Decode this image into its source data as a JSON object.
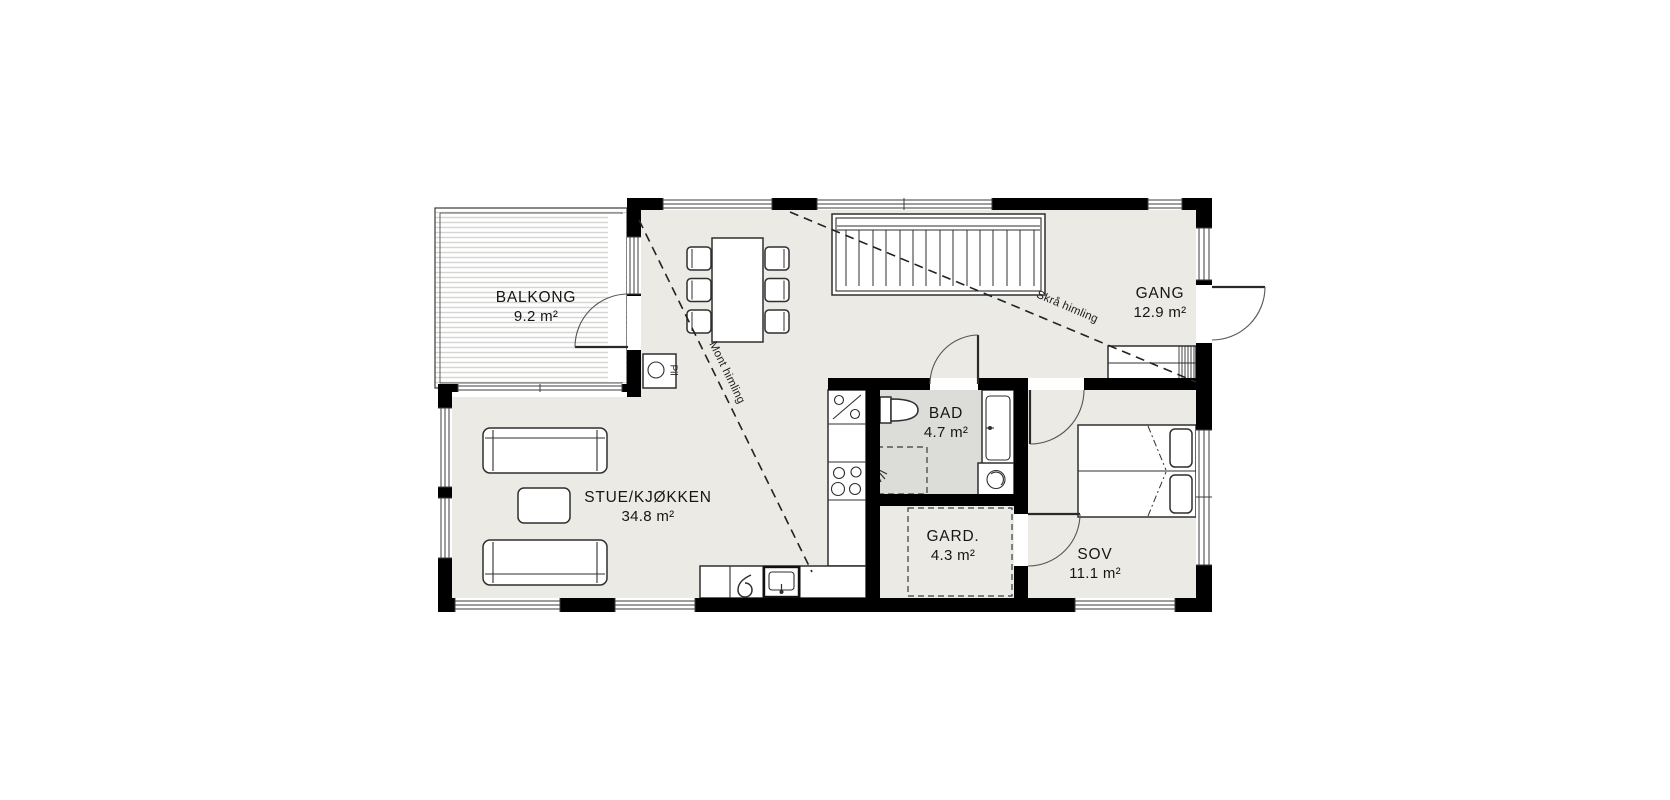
{
  "rooms": {
    "balkong": {
      "name": "BALKONG",
      "area": "9.2 m²"
    },
    "gang": {
      "name": "GANG",
      "area": "12.9 m²"
    },
    "bad": {
      "name": "BAD",
      "area": "4.7 m²"
    },
    "stue_kjokken": {
      "name": "STUE/KJØKKEN",
      "area": "34.8 m²"
    },
    "gard": {
      "name": "GARD.",
      "area": "4.3 m²"
    },
    "sov": {
      "name": "SOV",
      "area": "11.1 m²"
    }
  },
  "annotations": {
    "skra_himling": "Skrå himling",
    "mont_himling": "Mont himling",
    "pillar_label": "Pil"
  },
  "icons": {
    "stairs": "straight-stair-run",
    "dining-table": "table-with-six-chairs",
    "sofa": "three-seat-sofa",
    "coffee-table": "rectangular-table",
    "double-bed": "bed-with-two-pillows",
    "toilet": "wc-tank-and-bowl",
    "bathroom-sink": "vanity-with-faucet",
    "washing-machine": "square-with-drum-circle",
    "shower": "dashed-square-with-spray-head",
    "stove": "cabinet-with-diagonal-and-circles",
    "cooktop": "four-burner-circles",
    "kitchen-sink": "basin-with-faucet",
    "wardrobe-cabinet": "closet-with-hanger-hatch"
  },
  "colors": {
    "background": "#ffffff",
    "wall": "#000000",
    "floor": "#eceae4",
    "wet_room_floor": "#dcdcd8",
    "balcony_stripe": "#d6d6d1",
    "line": "#2f2f2f"
  }
}
